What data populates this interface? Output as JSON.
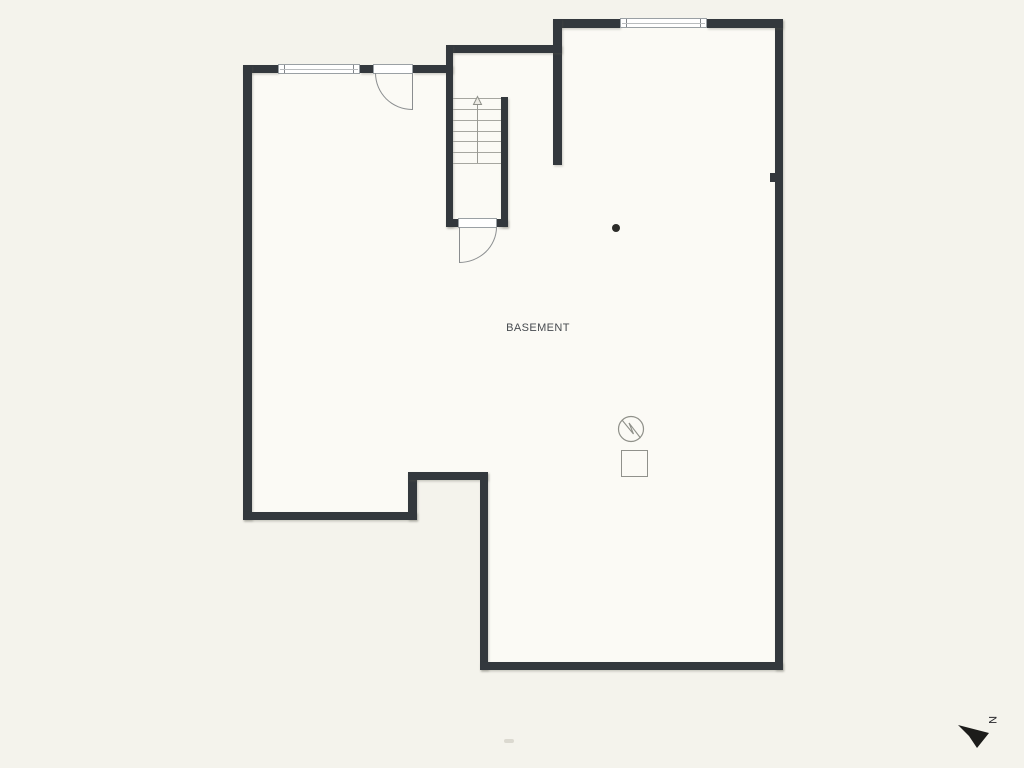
{
  "plan": {
    "room_label": "BASEMENT",
    "compass": {
      "north_label": "N",
      "icon": "north-arrow-icon"
    },
    "stairs": {
      "direction": "up",
      "treads": 7,
      "icon": "stairs-up-arrow-icon"
    },
    "windows": [
      {
        "name": "window-top-left"
      },
      {
        "name": "window-top-right"
      }
    ],
    "doors": [
      {
        "name": "entry-door-top"
      },
      {
        "name": "stair-door-bottom"
      }
    ],
    "symbols": [
      {
        "name": "utility-circle-zigzag-icon"
      },
      {
        "name": "utility-square-icon"
      },
      {
        "name": "column-dot-marker"
      }
    ],
    "colors": {
      "wall": "#33383d",
      "background": "#f4f3ec",
      "floor": "#fbfaf5",
      "line": "#8a8d8f",
      "text": "#474b50",
      "compass": "#1c1c1a"
    }
  }
}
